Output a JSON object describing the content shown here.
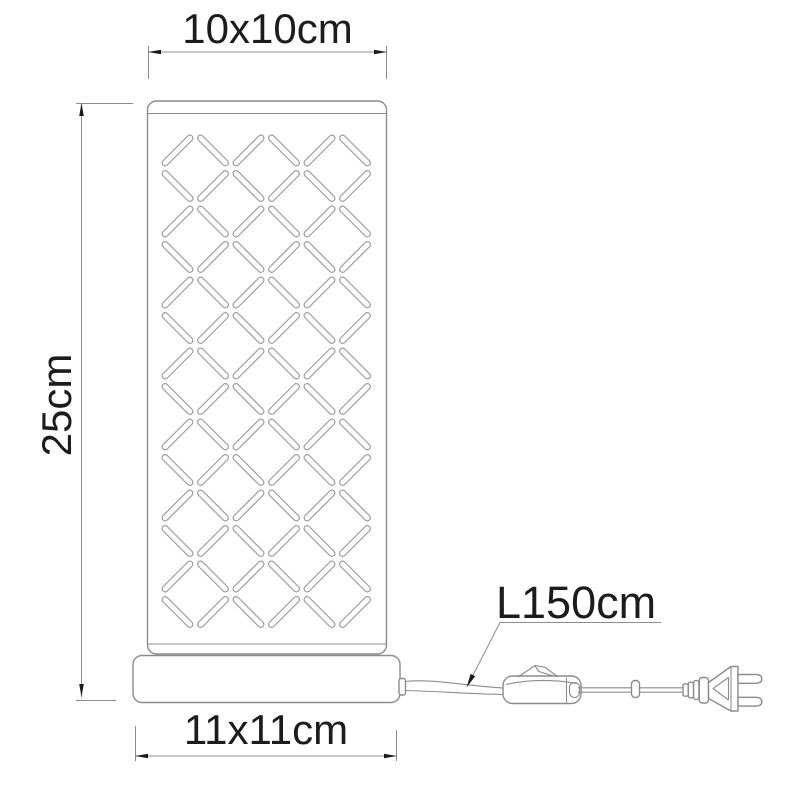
{
  "labels": {
    "shade_size": "10x10cm",
    "lamp_height": "25cm",
    "base_size": "11x11cm",
    "cable_length": "L150cm"
  },
  "lamp": {
    "pattern": {
      "rows": 14,
      "cols": 6,
      "pitch": 35.5,
      "origin_x": 177.5,
      "origin_y": 150.5,
      "slot_length": 41,
      "slot_thickness": 6,
      "alternating_directions": [
        "/",
        "\\"
      ]
    }
  },
  "colors": {
    "line_gray": "#8c8c8c",
    "pattern_gray": "#9c9c9c",
    "ink": "#1c1c1c",
    "background": "#ffffff"
  }
}
